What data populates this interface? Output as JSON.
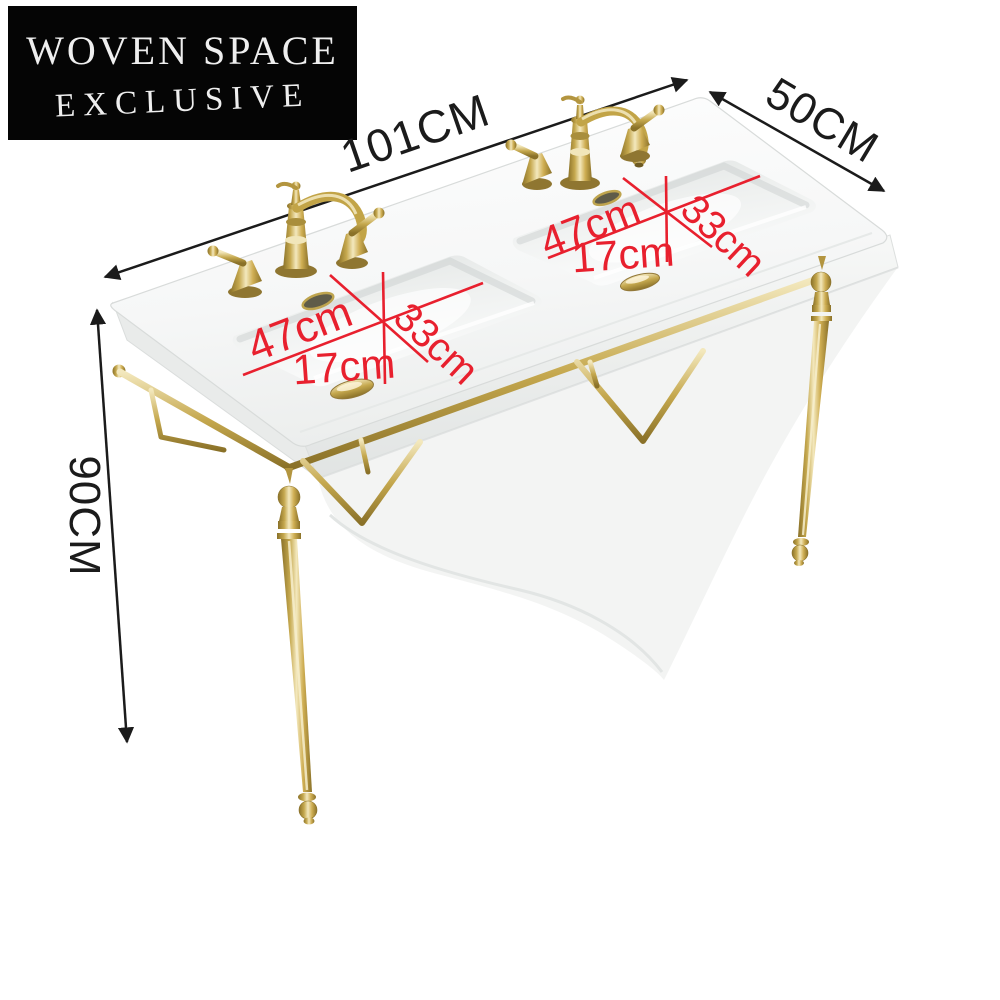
{
  "banner": {
    "line1": "WOVEN SPACE",
    "line2": "EXCLUSIVE"
  },
  "dimensions": {
    "width": {
      "label": "101CM"
    },
    "depth": {
      "label": "50CM"
    },
    "height": {
      "label": "90CM"
    }
  },
  "basin_annotations": {
    "left_basin": {
      "length": "47cm",
      "width": "33cm",
      "depth": "17cm"
    },
    "right_basin": {
      "length": "47cm",
      "width": "33cm",
      "depth": "17cm"
    }
  },
  "colors": {
    "banner_bg": "#050505",
    "banner_text": "#efefef",
    "dimension": "#1b1b1b",
    "annotation_red": "#e8202e",
    "gold": "#c7a94f",
    "gold_dark": "#8a7128",
    "gold_light": "#f3e8bd",
    "ceramic": "#f7f8f7",
    "ceramic_shadow": "#e9ebea"
  }
}
